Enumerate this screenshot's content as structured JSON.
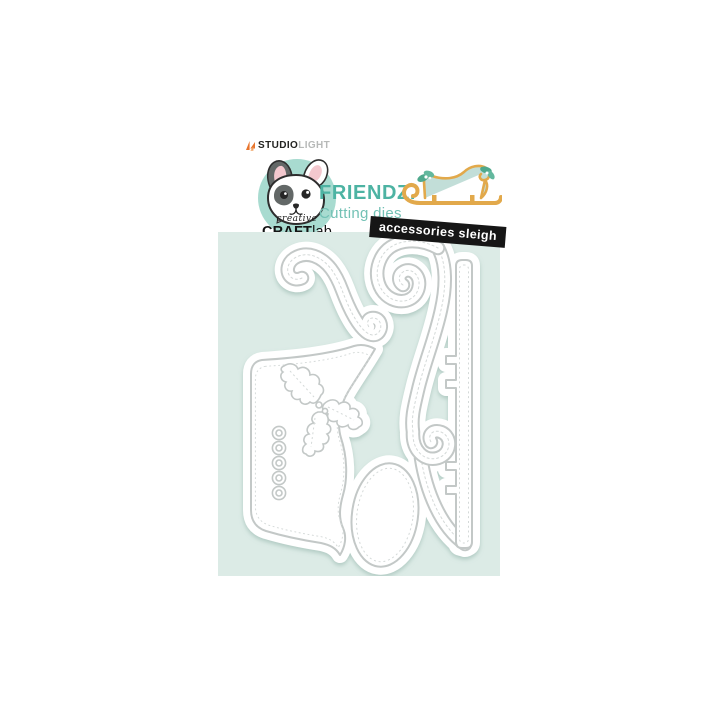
{
  "window": {
    "background": "#ffffff"
  },
  "brand": {
    "mark_color": "#e8742c",
    "studio": "STUDIO",
    "light": "LIGHT"
  },
  "logo": {
    "script": "creative",
    "craft": "CRAFT",
    "lab": "lab"
  },
  "product": {
    "line": "FRIENDZ.",
    "category": "Cutting dies",
    "variant": "accessories sleigh",
    "colors": {
      "title": "#4db3a3",
      "subtitle": "#73c1b5",
      "badge_bg": "#161616",
      "badge_text": "#ffffff",
      "panel": "#dcebe6",
      "die_outline": "#c3c8c7",
      "die_fill": "#ffffff",
      "stitch": "#d4d9d8",
      "logo_circle": "#a8dbd0",
      "sleigh_gold": "#e2a94b",
      "sleigh_body": "#c2ded8",
      "holly_green": "#4fa98d"
    },
    "die_pieces": [
      "sleigh body with swirl back",
      "holly sprig",
      "five-dot strip",
      "curled runner swirl",
      "notched runner blade",
      "oval"
    ]
  }
}
